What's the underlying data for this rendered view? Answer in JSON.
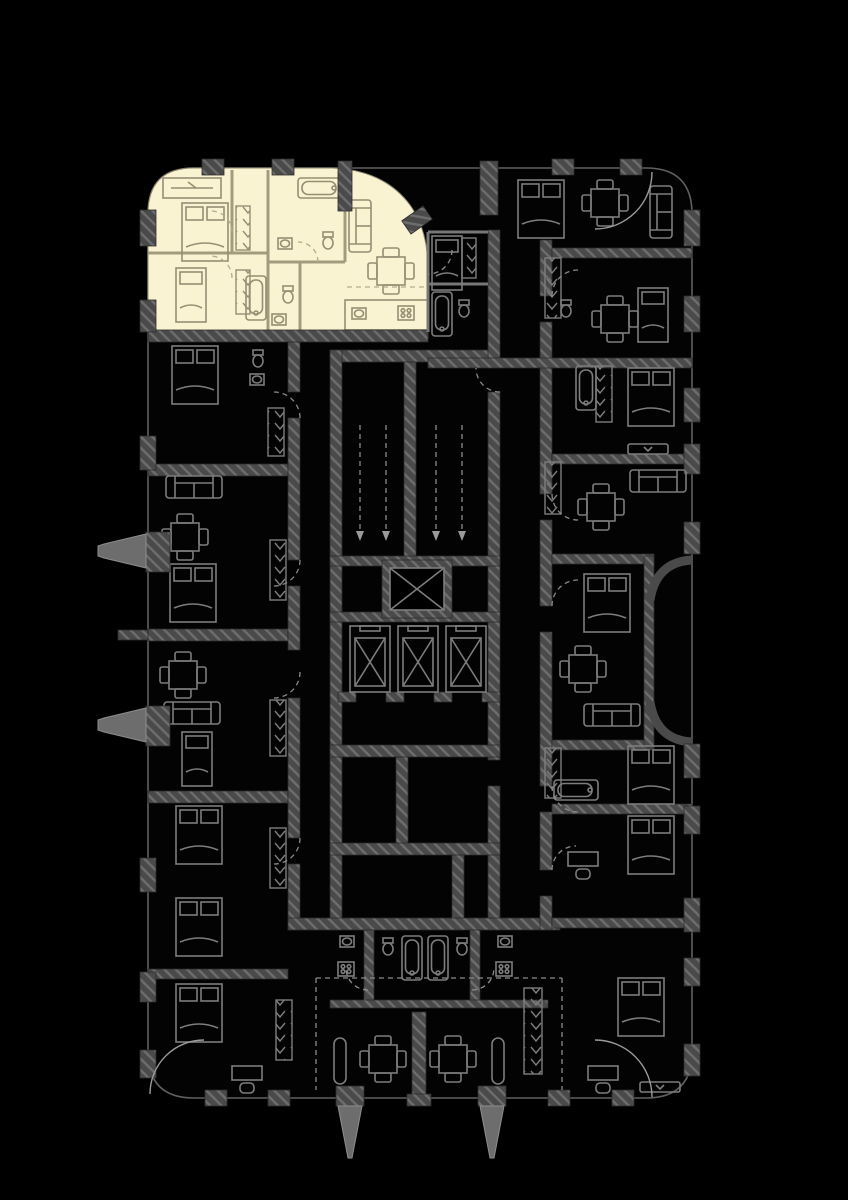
{
  "meta": {
    "page_type": "architectural-floor-plan",
    "description": "Residential tower floor plate on a black background; one apartment at the top-left is highlighted in cream, all other units drawn as dark line-work",
    "visible_text_present": false
  },
  "colors": {
    "background": "#000000",
    "highlight_fill": "#FAF3D2",
    "wall_fill": "#4A4A4A",
    "wall_hatch": "#6D6D6D",
    "facade_line": "#606060",
    "furniture": "#7D7D7D",
    "furniture_highlight": "#968E73",
    "dashed": "#8A8A8A"
  },
  "highlighted_apartment": {
    "position": "top-left",
    "selected": true,
    "furniture_icons": [
      "wardrobe-icon",
      "double-bed-icon",
      "single-bed-icon",
      "bathtub-icon",
      "toilet-icon",
      "sink-icon",
      "sofa-icon",
      "dining-table-icon",
      "kitchen-counter-icon",
      "closet-rail-icon"
    ]
  },
  "core": {
    "elevator_count": 3,
    "stair_flights": 2,
    "icons": [
      "elevator-icon",
      "stair-direction-arrow-icon",
      "shaft-cross-icon"
    ]
  },
  "exterior": {
    "left_columns": 2,
    "bottom_columns": 2,
    "terrace_icons": [
      "dining-table-icon",
      "bench-icon"
    ]
  },
  "style": {
    "wall_render": "hatched",
    "door_swing": "dashed-arc"
  }
}
